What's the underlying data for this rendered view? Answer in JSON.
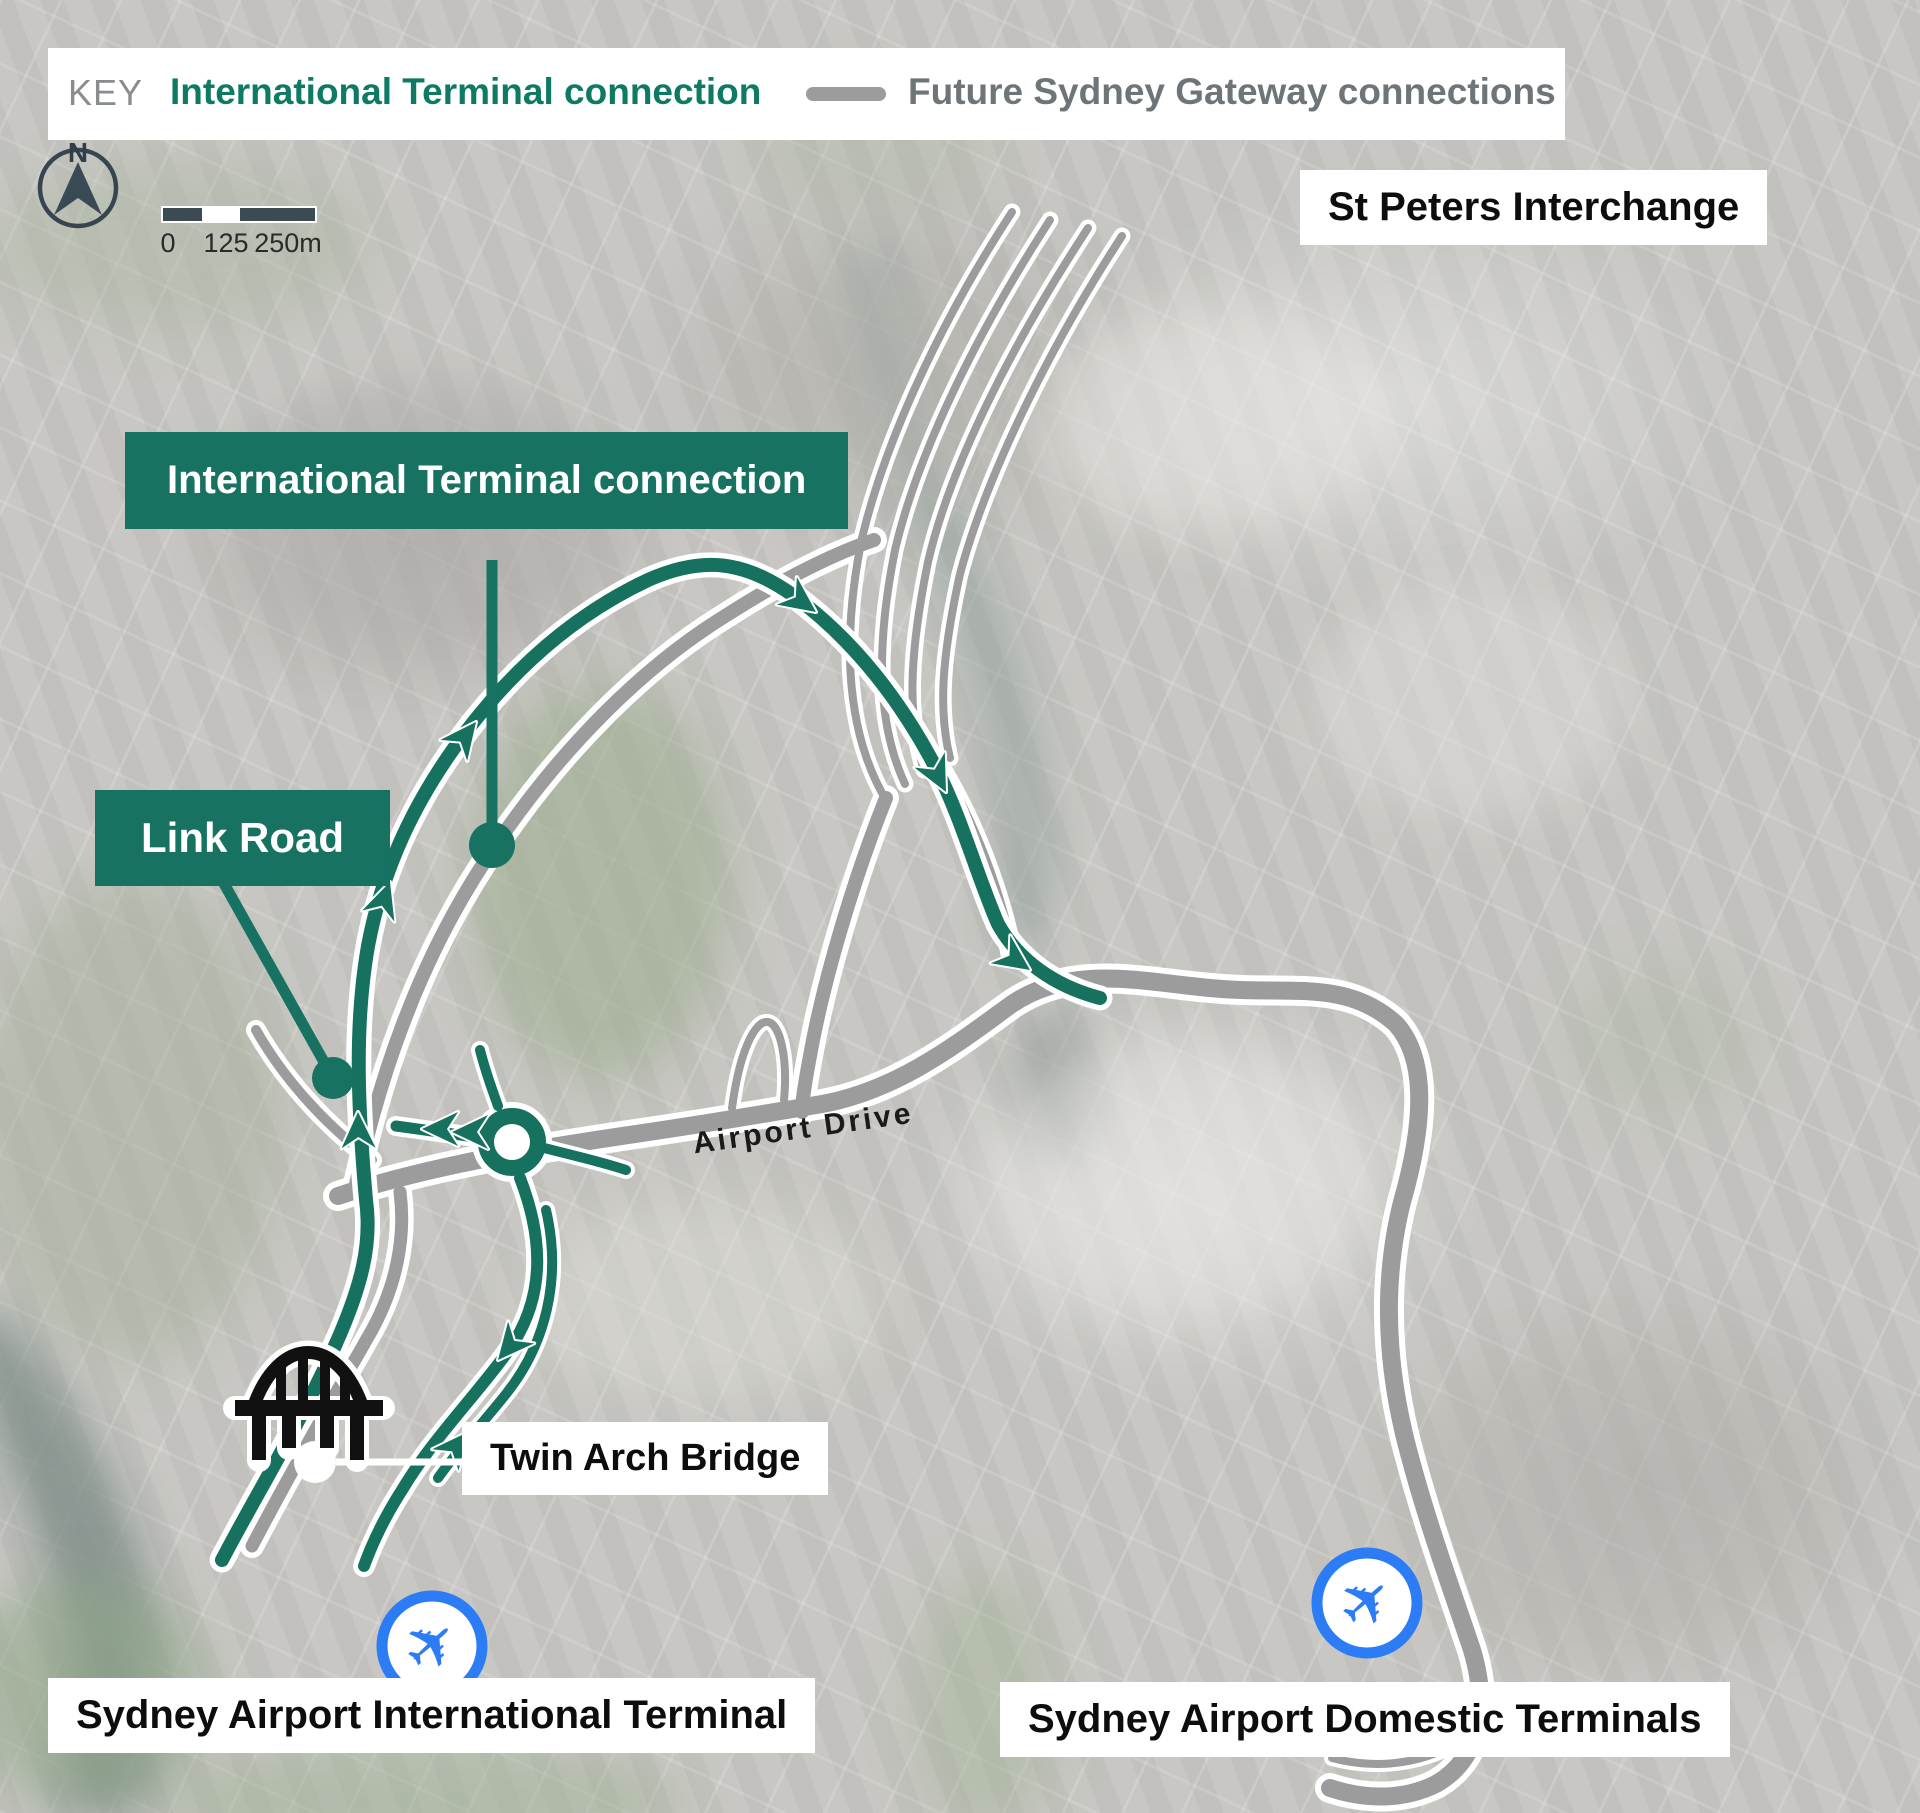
{
  "key": {
    "title": "KEY",
    "green_item": "International Terminal connection",
    "gray_item": "Future Sydney Gateway connections"
  },
  "compass": {
    "north": "N"
  },
  "scalebar": {
    "start": "0",
    "middle": "125",
    "end": "250m"
  },
  "callouts": {
    "st_peters": "St Peters Interchange",
    "international_connection": "International Terminal connection",
    "link_road": "Link Road",
    "twin_arch": "Twin Arch Bridge",
    "airport_drive": "Airport Drive",
    "international_terminal": "Sydney Airport International Terminal",
    "domestic_terminals": "Sydney Airport Domestic Terminals"
  },
  "icons": {
    "airplane": "✈"
  },
  "colors": {
    "route_green": "#17715F",
    "callout_green_bg": "#187261",
    "key_green_text": "#0E7A63",
    "road_gray": "#9C9C9C",
    "plane_blue": "#2B7CF5",
    "compass_dark": "#3A4A55"
  }
}
